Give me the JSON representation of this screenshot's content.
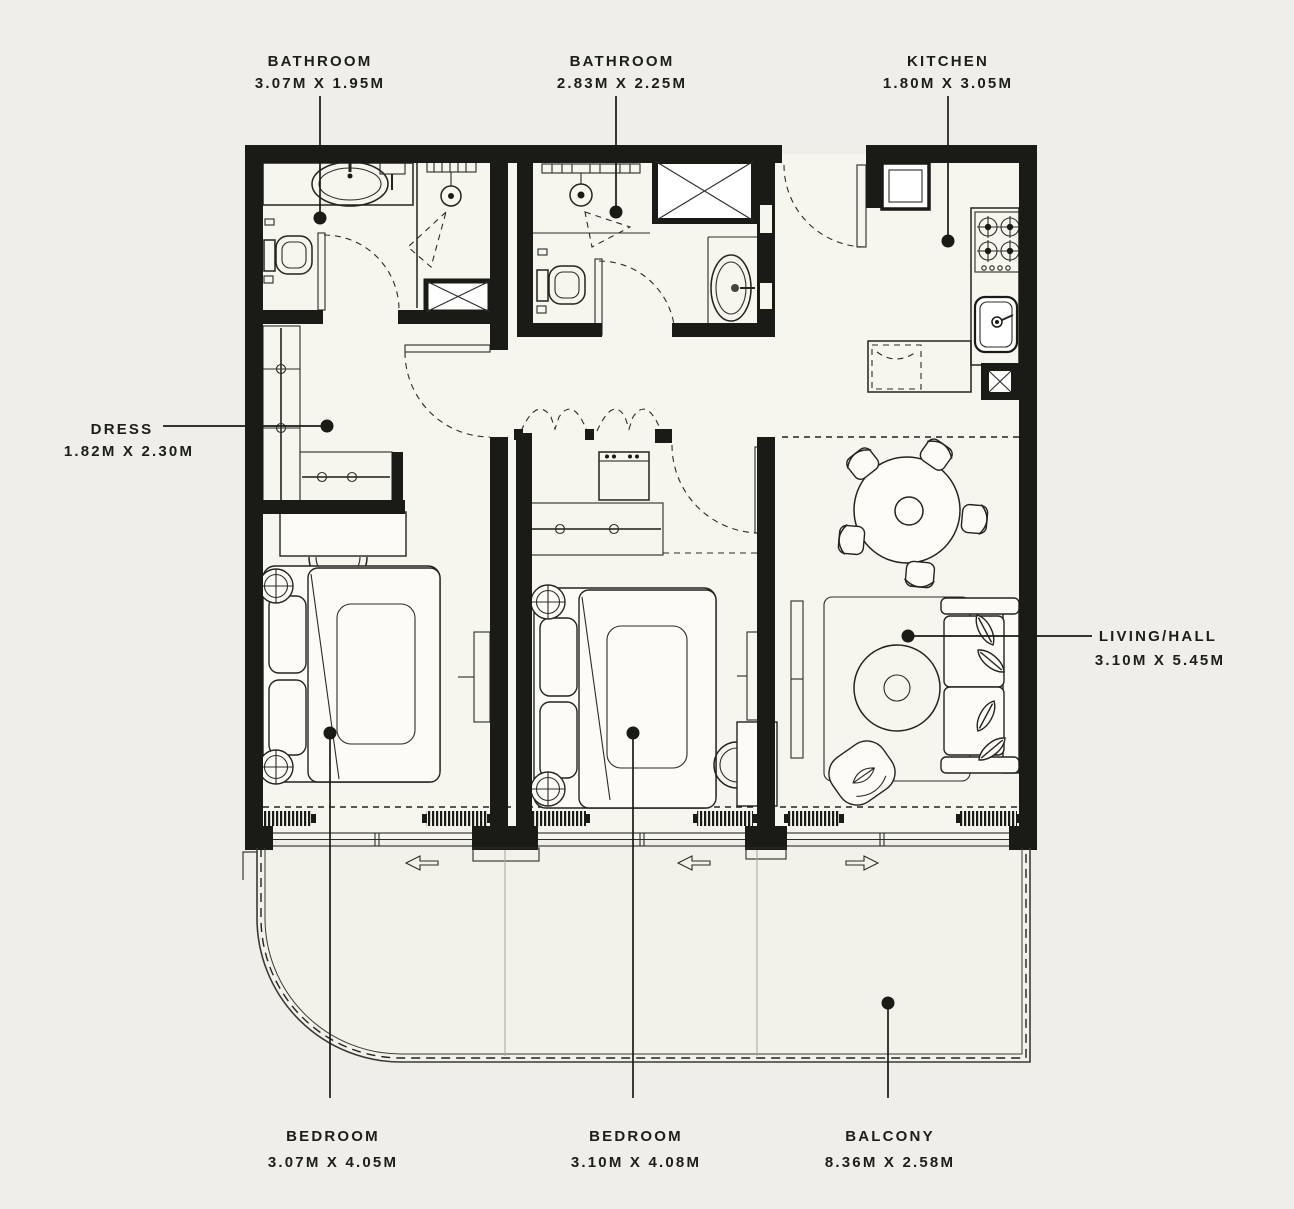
{
  "plan": {
    "background": "#efeee8",
    "ink": "#1a1a17",
    "rooms": [
      {
        "id": "bathroom-1",
        "label": "BATHROOM",
        "dimensions": "3.07M X 1.95M"
      },
      {
        "id": "bathroom-2",
        "label": "BATHROOM",
        "dimensions": "2.83M X 2.25M"
      },
      {
        "id": "kitchen",
        "label": "KITCHEN",
        "dimensions": "1.80M X 3.05M"
      },
      {
        "id": "dress",
        "label": "DRESS",
        "dimensions": "1.82M X 2.30M"
      },
      {
        "id": "living",
        "label": "LIVING/HALL",
        "dimensions": "3.10M X 5.45M"
      },
      {
        "id": "bedroom-1",
        "label": "BEDROOM",
        "dimensions": "3.07M X 4.05M"
      },
      {
        "id": "bedroom-2",
        "label": "BEDROOM",
        "dimensions": "3.10M X 4.08M"
      },
      {
        "id": "balcony",
        "label": "BALCONY",
        "dimensions": "8.36M X 2.58M"
      }
    ]
  }
}
